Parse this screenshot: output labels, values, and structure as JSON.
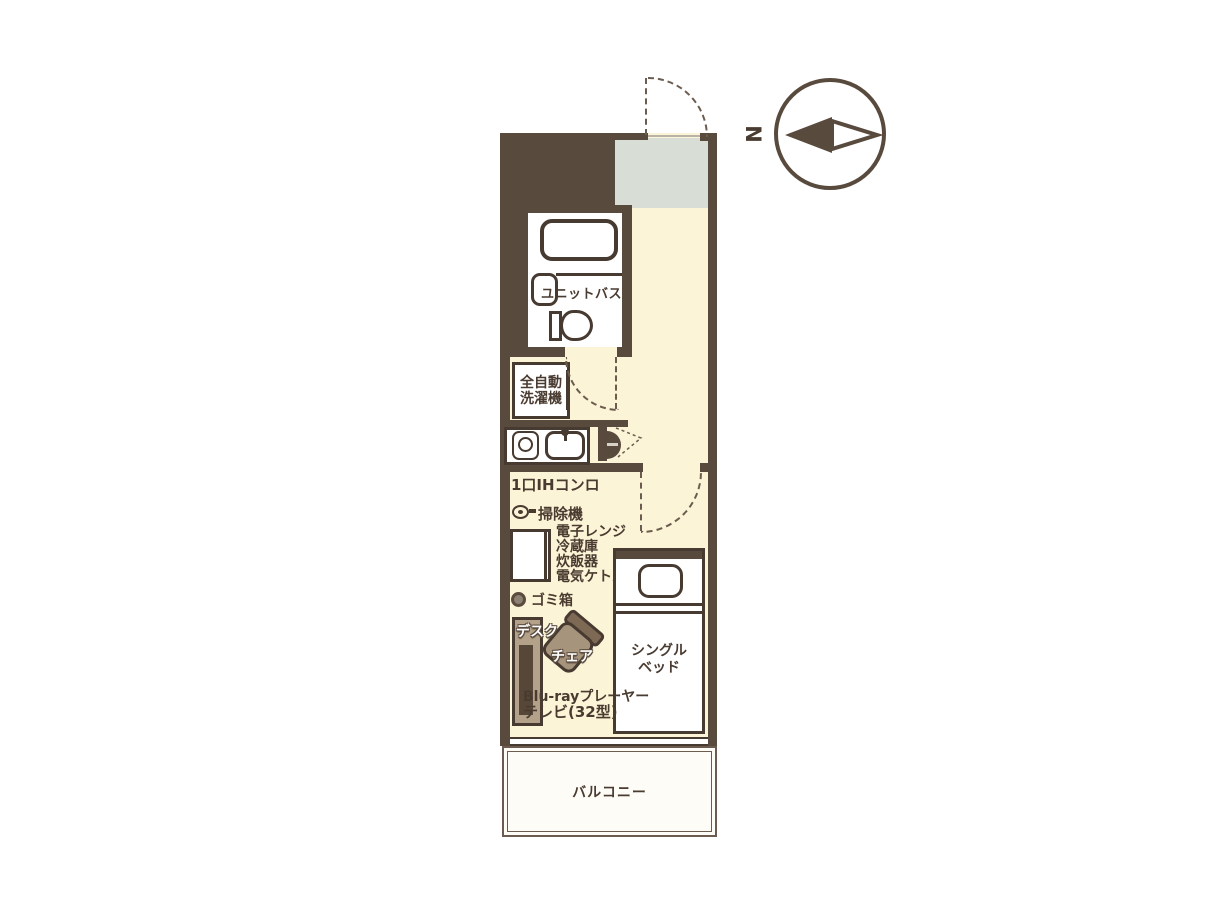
{
  "labels": {
    "unit_bath": "ユニットバス",
    "washer_line1": "全自動",
    "washer_line2": "洗濯機",
    "stove": "1口IHコンロ",
    "vacuum": "掃除機",
    "appliances": [
      "電子レンジ",
      "冷蔵庫",
      "炊飯器",
      "電気ケトル"
    ],
    "trash": "ゴミ箱",
    "desk": "デスク",
    "chair": "チェア",
    "bluray": "Blu-rayプレーヤー",
    "tv": "テレビ(32型)",
    "bed_line1": "シングル",
    "bed_line2": "ベッド",
    "balcony": "バルコニー",
    "north": "N"
  },
  "colors": {
    "wall": "#594a3e",
    "line": "#473a30",
    "floor": "#fbf4d7",
    "entry": "#d8ddd5",
    "white": "#ffffff",
    "text": "#4a3b30",
    "dash": "#6b5c4f",
    "desk": "#b3a189",
    "deskin": "#564738",
    "seat": "#a7947d",
    "back": "#7e6a54",
    "balcony": "#fdfcf7"
  }
}
